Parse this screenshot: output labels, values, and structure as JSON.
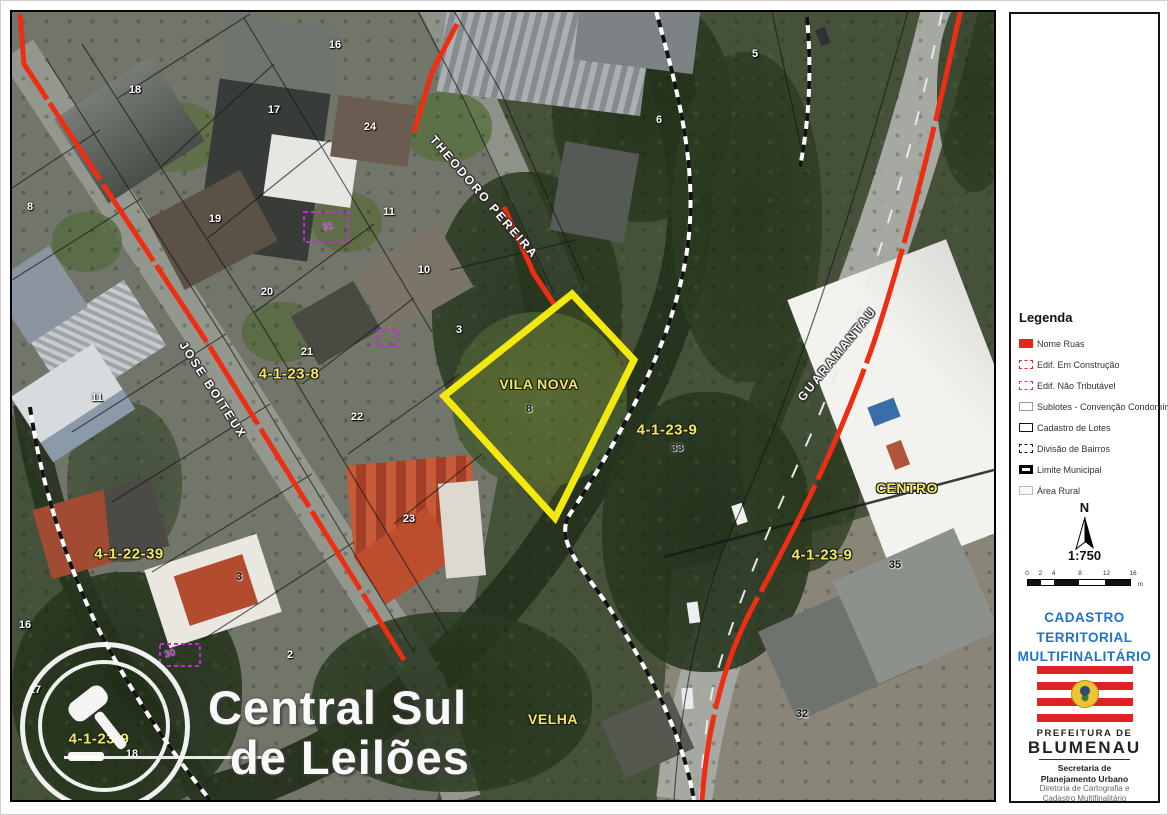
{
  "watermark": {
    "line1": "Central Sul",
    "line2": "de Leilões",
    "logo": "gavel-icon"
  },
  "map": {
    "highlighted_lot": {
      "neighborhood": "VILA NOVA",
      "lot_number": "8",
      "outline_color": "#f4e90f"
    },
    "neighborhood_labels": [
      {
        "text": "VILA NOVA",
        "x": 527,
        "y": 372
      },
      {
        "text": "CENTRO",
        "x": 895,
        "y": 476
      },
      {
        "text": "VELHA",
        "x": 541,
        "y": 707
      }
    ],
    "sector_labels": [
      {
        "text": "4-1-23-8",
        "x": 277,
        "y": 362
      },
      {
        "text": "4-1-22-39",
        "x": 117,
        "y": 542
      },
      {
        "text": "4-1-23-9",
        "x": 655,
        "y": 418
      },
      {
        "text": "4-1-23-9",
        "x": 810,
        "y": 543
      },
      {
        "text": "4-1-23-9",
        "x": 87,
        "y": 727
      }
    ],
    "street_labels": [
      {
        "text": "JOSE BOITEUX",
        "x": 201,
        "y": 378,
        "rot": 57
      },
      {
        "text": "THEODORO PEREIRA",
        "x": 472,
        "y": 185,
        "rot": 49
      },
      {
        "text": "GUARAMANTAU",
        "x": 825,
        "y": 342,
        "rot": -51
      }
    ],
    "house_numbers": [
      {
        "text": "18",
        "x": 123,
        "y": 78,
        "tone": "light"
      },
      {
        "text": "16",
        "x": 323,
        "y": 33,
        "tone": "light"
      },
      {
        "text": "17",
        "x": 262,
        "y": 98,
        "tone": "light"
      },
      {
        "text": "24",
        "x": 358,
        "y": 115,
        "tone": "light"
      },
      {
        "text": "8",
        "x": 18,
        "y": 195,
        "tone": "light"
      },
      {
        "text": "19",
        "x": 203,
        "y": 207,
        "tone": "light"
      },
      {
        "text": "11",
        "x": 377,
        "y": 200,
        "tone": "light"
      },
      {
        "text": "20",
        "x": 255,
        "y": 280,
        "tone": "light"
      },
      {
        "text": "10",
        "x": 412,
        "y": 258,
        "tone": "light"
      },
      {
        "text": "3",
        "x": 447,
        "y": 318,
        "tone": "light"
      },
      {
        "text": "21",
        "x": 295,
        "y": 340,
        "tone": "light"
      },
      {
        "text": "22",
        "x": 345,
        "y": 405,
        "tone": "light"
      },
      {
        "text": "23",
        "x": 397,
        "y": 507,
        "tone": "light"
      },
      {
        "text": "11",
        "x": 85,
        "y": 386,
        "tone": "light"
      },
      {
        "text": "5",
        "x": 743,
        "y": 42,
        "tone": "light"
      },
      {
        "text": "6",
        "x": 647,
        "y": 108,
        "tone": "light"
      },
      {
        "text": "2",
        "x": 278,
        "y": 643,
        "tone": "light"
      },
      {
        "text": "1",
        "x": 342,
        "y": 695,
        "tone": "light"
      },
      {
        "text": "16",
        "x": 13,
        "y": 613,
        "tone": "light"
      },
      {
        "text": "17",
        "x": 23,
        "y": 678,
        "tone": "light"
      },
      {
        "text": "18",
        "x": 120,
        "y": 742,
        "tone": "light"
      },
      {
        "text": "8",
        "x": 517,
        "y": 397,
        "tone": "dark"
      },
      {
        "text": "33",
        "x": 665,
        "y": 436,
        "tone": "dark"
      },
      {
        "text": "35",
        "x": 883,
        "y": 553,
        "tone": "dark"
      },
      {
        "text": "32",
        "x": 790,
        "y": 702,
        "tone": "dark"
      },
      {
        "text": "3",
        "x": 227,
        "y": 565,
        "tone": "dark"
      }
    ],
    "misc_labels": [
      {
        "text": "30",
        "x": 158,
        "y": 642,
        "rot": -15
      },
      {
        "text": "31",
        "x": 316,
        "y": 215,
        "rot": -12
      }
    ]
  },
  "panel": {
    "legend": {
      "title": "Legenda",
      "items": [
        {
          "label": "Nome Ruas",
          "swatch": "ruas"
        },
        {
          "label": "Edif. Em Construção",
          "swatch": "construcao"
        },
        {
          "label": "Edif. Não Tributável",
          "swatch": "naotrib"
        },
        {
          "label": "Sublotes - Convenção Condomínio",
          "swatch": "sublotes"
        },
        {
          "label": "Cadastro de Lotes",
          "swatch": "lotes"
        },
        {
          "label": "Divisão de Bairros",
          "swatch": "bairros"
        },
        {
          "label": "Limite Municipal",
          "swatch": "municipal"
        },
        {
          "label": "Área Rural",
          "swatch": "rural"
        }
      ]
    },
    "north_label": "N",
    "scale_text": "1:750",
    "scale_ticks": [
      "0",
      "2",
      "4",
      "8",
      "12",
      "16"
    ],
    "scale_unit": "m",
    "title_lines": [
      "CADASTRO",
      "TERRITORIAL",
      "MULTIFINALITÁRIO"
    ],
    "org": {
      "line1": "PREFEITURA DE",
      "line2": "BLUMENAU",
      "dept1": "Secretaria de",
      "dept2": "Planejamento Urbano",
      "dir1": "Diretoria de Cartografia e",
      "dir2": "Cadastro Multifinalitário"
    }
  },
  "colors": {
    "road_red": "#ee2d12",
    "lot_yellow": "#f4e90f",
    "sector_yellow": "#f1e75e",
    "title_blue": "#1e73cf",
    "legend_red": "#e8251a",
    "legend_purple": "#b03fc0",
    "flag_red": "#e02128"
  }
}
